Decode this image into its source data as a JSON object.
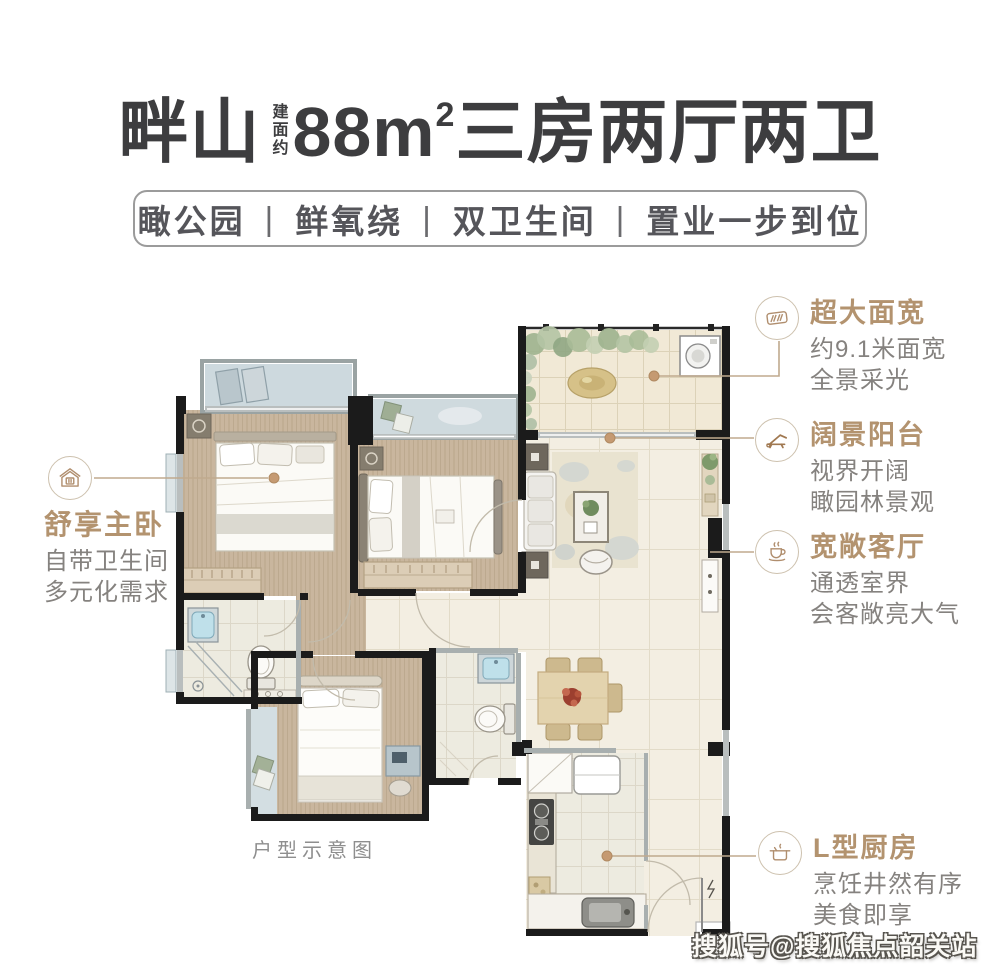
{
  "header": {
    "title": {
      "name": "畔山",
      "area_note": "建面约",
      "size": "88m",
      "size_sup": "2",
      "rooms": "三房两厅两卫"
    },
    "tagline": {
      "items": [
        "瞰公园",
        "鲜氧绕",
        "双卫生间",
        "置业一步到位"
      ],
      "separator": "|"
    }
  },
  "annotations": {
    "master": {
      "icon": "house-icon",
      "title": "舒享主卧",
      "line1": "自带卫生间",
      "line2": "多元化需求"
    },
    "width": {
      "icon": "window-icon",
      "title": "超大面宽",
      "line1": "约9.1米面宽",
      "line2": "全景采光"
    },
    "balcony": {
      "icon": "lounge-chair-icon",
      "title": "阔景阳台",
      "line1": "视界开阔",
      "line2": "瞰园林景观"
    },
    "living": {
      "icon": "coffee-cup-icon",
      "title": "宽敞客厅",
      "line1": "通透室界",
      "line2": "会客敞亮大气"
    },
    "kitchen": {
      "icon": "cooking-pot-icon",
      "title": "L型厨房",
      "line1": "烹饪井然有序",
      "line2": "美食即享"
    }
  },
  "floorplan": {
    "caption": "户型示意图"
  },
  "watermark": "搜狐号@搜狐焦点韶关站",
  "colors": {
    "accent_tan": "#b3936f",
    "body_gray": "#85827f",
    "title_dark": "#3d3d3f",
    "wall_black": "#1b1b1b",
    "wall_gray": "#a8afaf",
    "wood_floor": "#c9b69e",
    "tile_floor": "#f3eee2",
    "balcony_floor": "#cdd9de",
    "connector_line": "#c0aa8e",
    "marker_dot": "#c59a72"
  }
}
